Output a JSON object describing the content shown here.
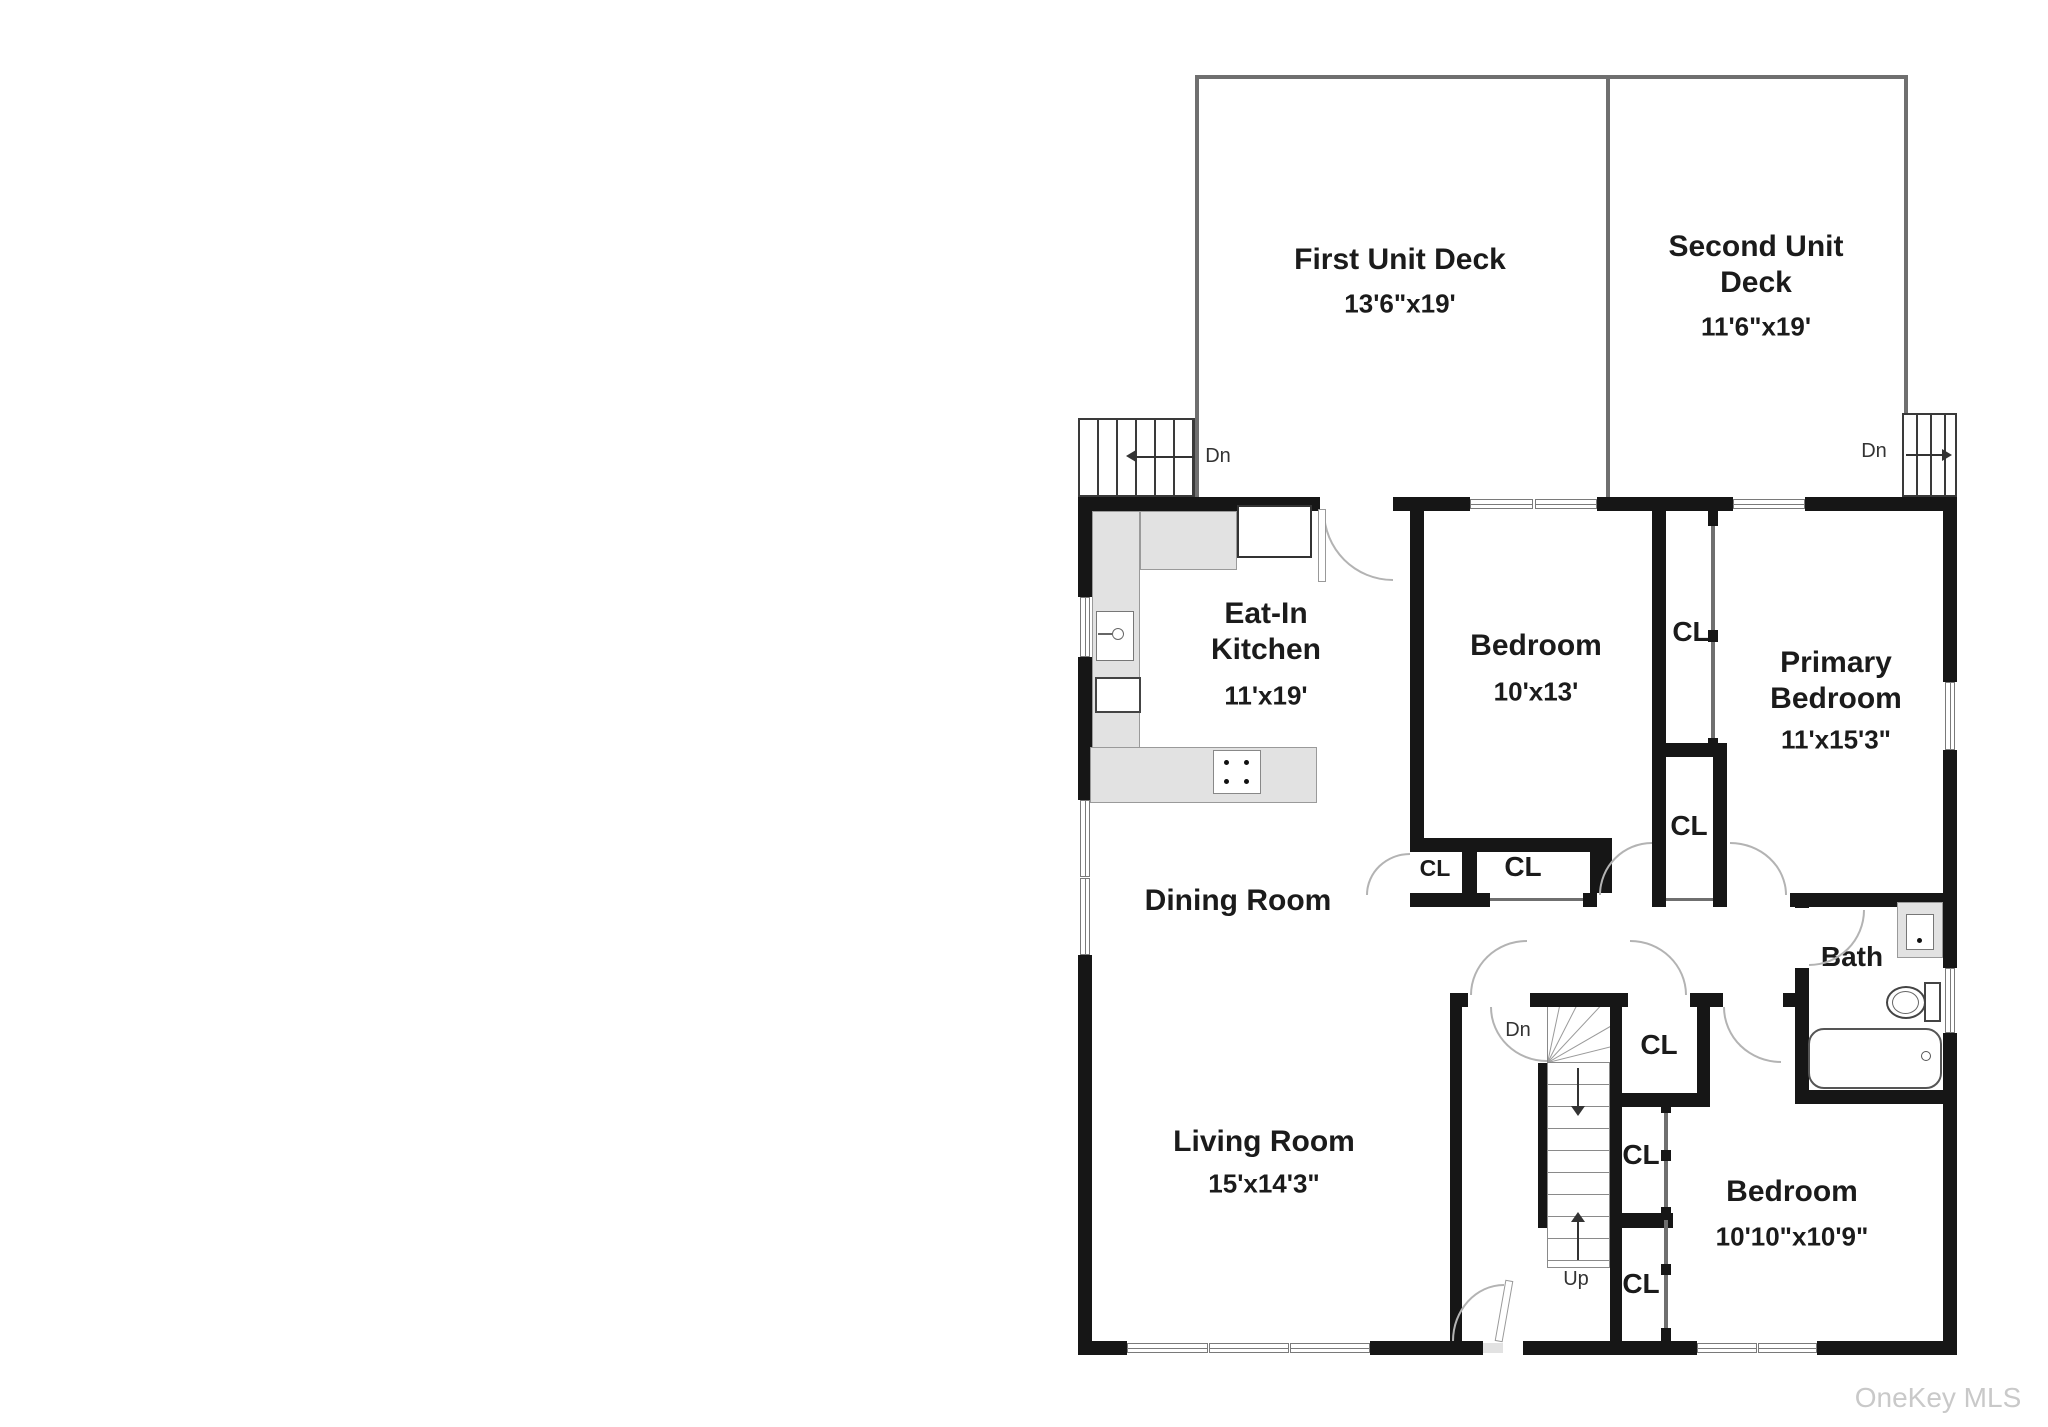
{
  "watermark": "OneKey MLS",
  "labels": {
    "closet": "CL",
    "down": "Dn",
    "up": "Up",
    "ref": "Ref",
    "dw": "DW"
  },
  "rooms": {
    "first_unit_deck": {
      "name": "First Unit Deck",
      "dims": "13'6\"x19'"
    },
    "second_unit_deck": {
      "name": "Second Unit Deck",
      "dims": "11'6\"x19'"
    },
    "eat_in_kitchen": {
      "name": "Eat-In Kitchen",
      "dims": "11'x19'"
    },
    "bedroom_upper": {
      "name": "Bedroom",
      "dims": "10'x13'"
    },
    "primary_bedroom": {
      "name": "Primary Bedroom",
      "dims": "11'x15'3\""
    },
    "dining_room": {
      "name": "Dining Room"
    },
    "living_room": {
      "name": "Living Room",
      "dims": "15'x14'3\""
    },
    "bedroom_lower": {
      "name": "Bedroom",
      "dims": "10'10\"x10'9\""
    },
    "bath": {
      "name": "Bath"
    }
  },
  "colors": {
    "wall": "#161616",
    "deck_line": "#6f6f6f",
    "counter": "#e2e2e2",
    "door_arc": "#b3b3b3",
    "watermark": "#c9c9c9"
  }
}
